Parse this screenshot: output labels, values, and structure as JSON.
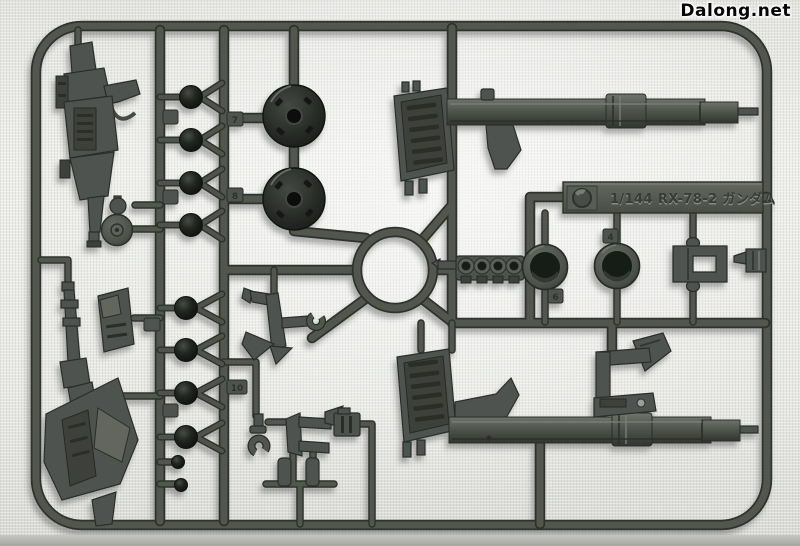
{
  "watermark": {
    "text": "Dalong.net"
  },
  "runner": {
    "label": {
      "scale_and_name": "1/144 RX-78-2 ガンダム",
      "emblem": "bandai-circle-emblem"
    },
    "gate_tags": [
      {
        "label": "7"
      },
      {
        "label": "8"
      },
      {
        "label": "10"
      },
      {
        "label": "4"
      },
      {
        "label": "6"
      }
    ],
    "colors": {
      "background": "#e9eae6",
      "plastic": "#4f534f",
      "plastic_dark": "#303430",
      "plastic_light": "#6c706c",
      "ball_joint": "#1a1d1a",
      "label_plate": "#575b55",
      "bottom_band": "#b0b1ad"
    },
    "parts": [
      {
        "name": "rifle-weapon-top-left",
        "count": 1
      },
      {
        "name": "rifle-weapon-bottom-left",
        "count": 1
      },
      {
        "name": "ball-joint",
        "count": 8
      },
      {
        "name": "dome-joint",
        "count": 2
      },
      {
        "name": "bazooka-half-upper",
        "count": 1
      },
      {
        "name": "bazooka-half-lower",
        "count": 1
      },
      {
        "name": "vented-stock",
        "count": 2
      },
      {
        "name": "barrel-ring-cylinder",
        "count": 2
      },
      {
        "name": "ring-strip",
        "count": 1
      },
      {
        "name": "u-bracket",
        "count": 1
      },
      {
        "name": "anchor-hook",
        "count": 1
      },
      {
        "name": "c-clip",
        "count": 2
      },
      {
        "name": "yoke-cradle",
        "count": 1
      },
      {
        "name": "disc-cap",
        "count": 1
      },
      {
        "name": "carry-handle-hook",
        "count": 1
      }
    ]
  }
}
